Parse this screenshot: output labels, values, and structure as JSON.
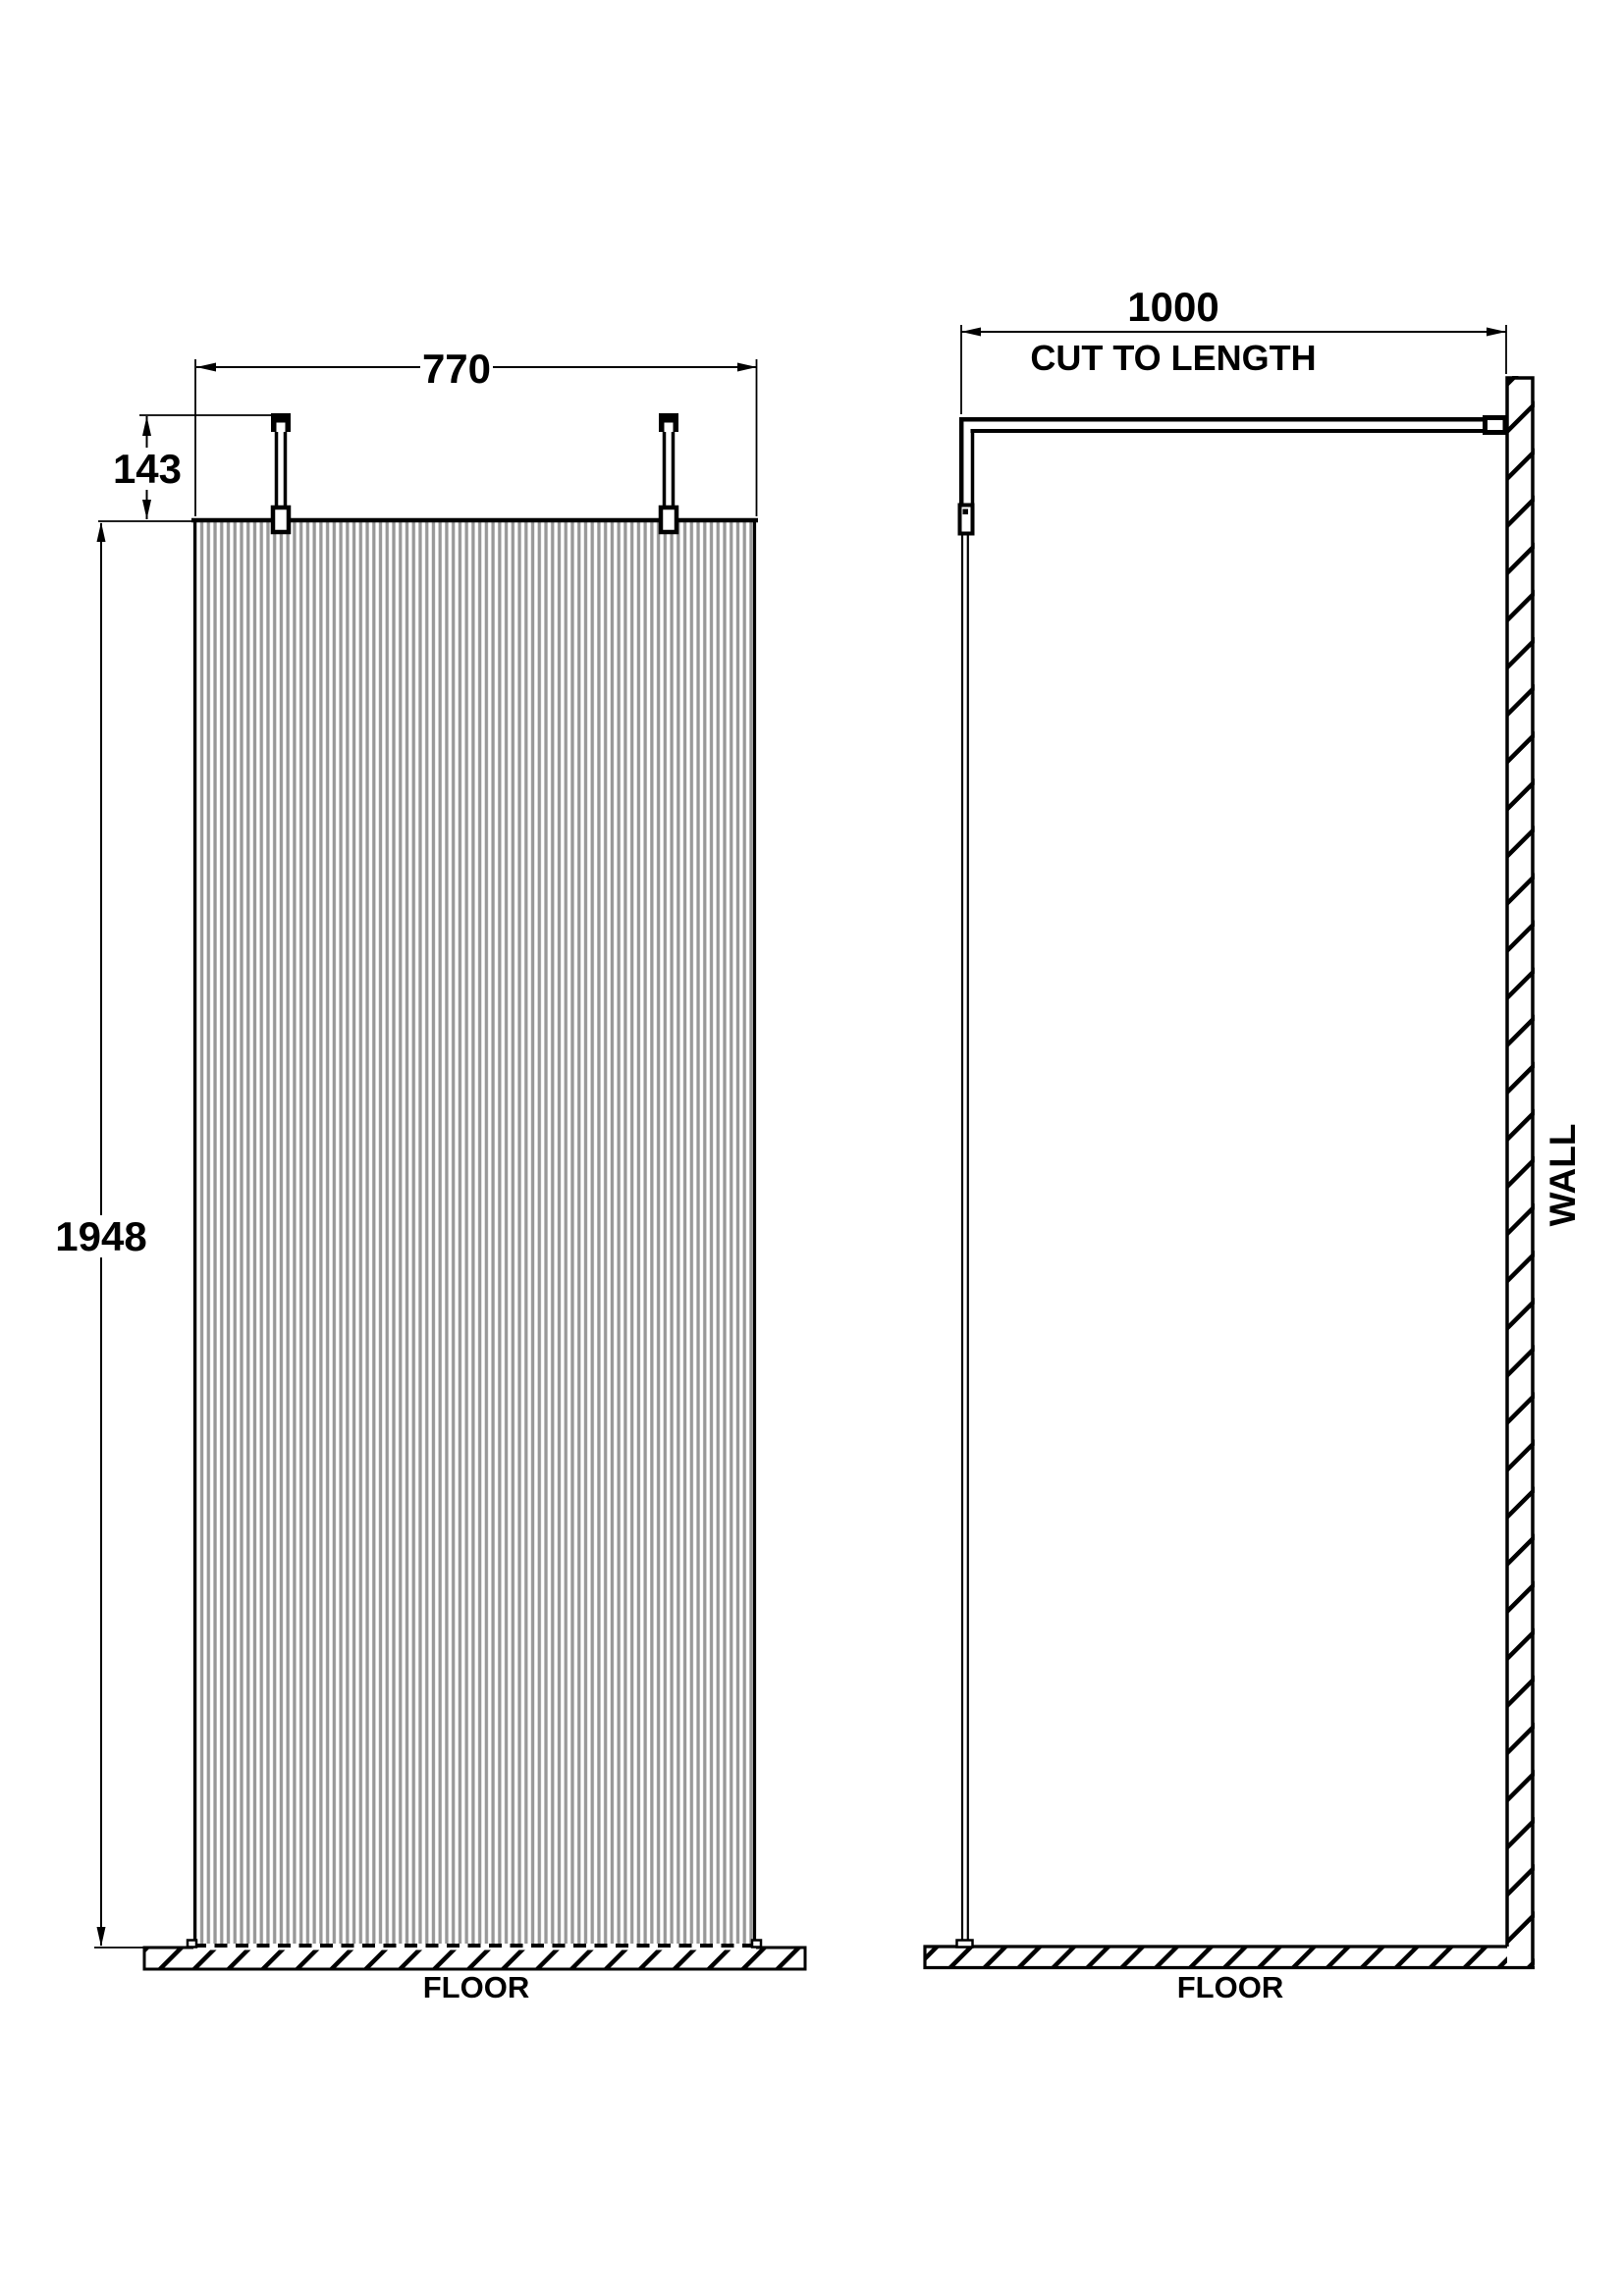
{
  "front_view": {
    "dim_width": "770",
    "dim_arm_drop": "143",
    "dim_height": "1948",
    "floor_label": "FLOOR"
  },
  "side_view": {
    "dim_arm_length": "1000",
    "dim_arm_note": "CUT TO LENGTH",
    "wall_label": "WALL",
    "floor_label": "FLOOR"
  },
  "colors": {
    "line": "#000000",
    "flute_gray": "#989898",
    "background": "#ffffff"
  }
}
